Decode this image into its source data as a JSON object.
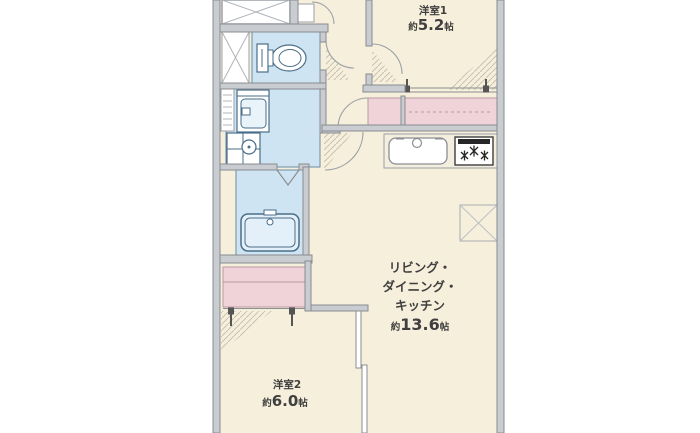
{
  "plan": {
    "rooms": {
      "room1": {
        "name": "洋室1",
        "area_prefix": "約",
        "area_value": "5.2",
        "area_unit": "帖"
      },
      "ldk": {
        "name_line1": "リビング・",
        "name_line2": "ダイニング・",
        "name_line3": "キッチン",
        "area_prefix": "約",
        "area_value": "13.6",
        "area_unit": "帖"
      },
      "room2": {
        "name": "洋室2",
        "area_prefix": "約",
        "area_value": "6.0",
        "area_unit": "帖"
      }
    },
    "colors": {
      "floor_cream": "#f6efdb",
      "wet_area_blue": "#cfe4f2",
      "closet_pink": "#f0d3d9",
      "wall_fill": "#c9ccd0",
      "wall_edge": "#888c90",
      "fixture_outline": "#4a6e88",
      "hatch": "#c9c2b0",
      "text": "#3f3f3f",
      "background": "#ffffff"
    }
  }
}
